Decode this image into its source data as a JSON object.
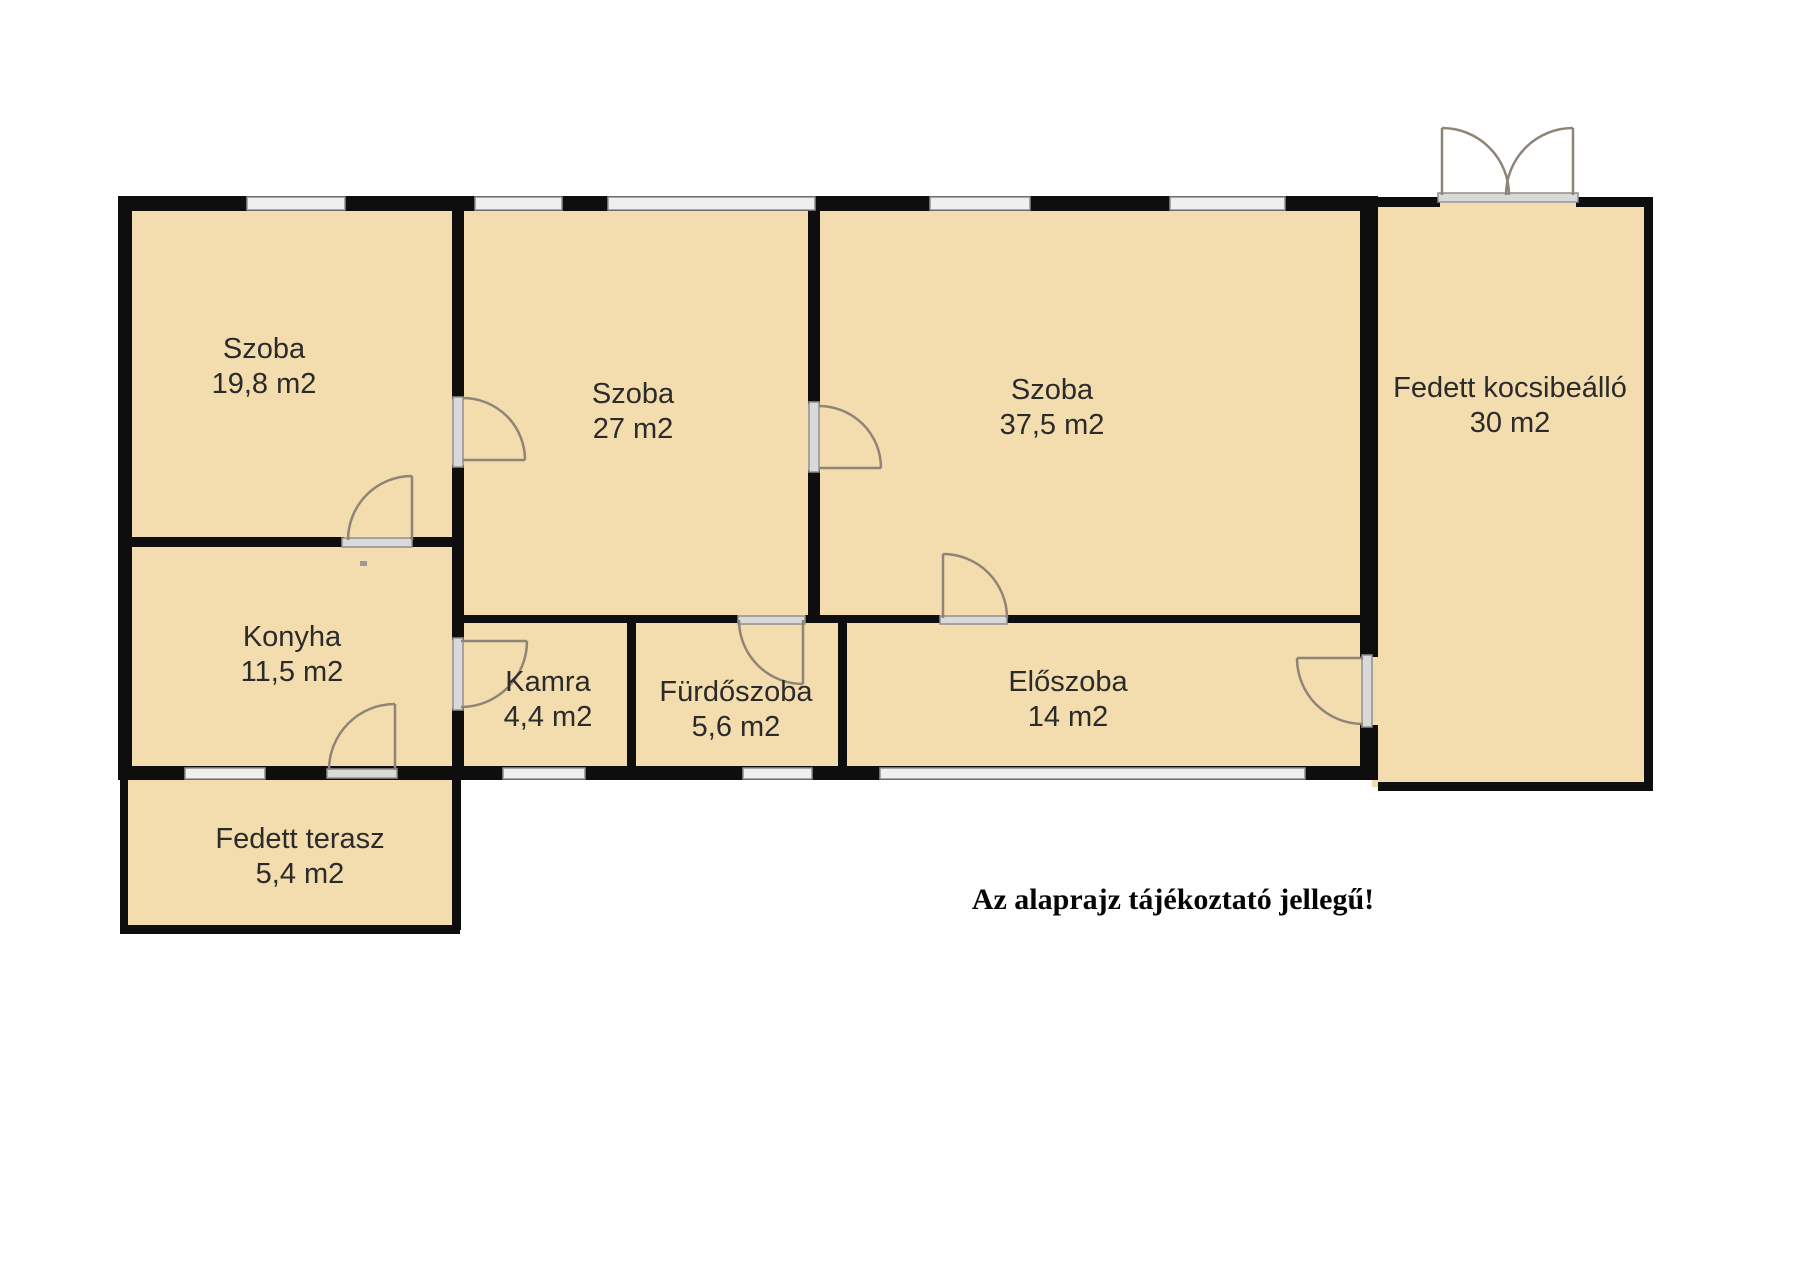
{
  "plan": {
    "disclaimer": "Az alaprajz tájékoztató jellegű!",
    "disclaimer_pos": {
      "x": 1173,
      "y": 900
    },
    "colors": {
      "floor": "#f3dcae",
      "wall": "#0e0e0e",
      "window_fill": "#efefef",
      "window_edge": "#8f8f8f",
      "door_bar_fill": "#d9d9d9",
      "door_bar_edge": "#8f8f8f",
      "door_arc": "#8e8577",
      "label_text": "#2b2b2b",
      "background": "#ffffff"
    },
    "rooms": [
      {
        "key": "szoba-19-8",
        "name": "Szoba",
        "area": "19,8 m2",
        "x": 264,
        "y": 367
      },
      {
        "key": "szoba-27",
        "name": "Szoba",
        "area": "27 m2",
        "x": 633,
        "y": 412
      },
      {
        "key": "szoba-37-5",
        "name": "Szoba",
        "area": "37,5 m2",
        "x": 1052,
        "y": 408
      },
      {
        "key": "fedett-kocsibeallo",
        "name": "Fedett kocsibeálló",
        "area": "30 m2",
        "x": 1510,
        "y": 406
      },
      {
        "key": "konyha",
        "name": "Konyha",
        "area": "11,5 m2",
        "x": 292,
        "y": 655
      },
      {
        "key": "kamra",
        "name": "Kamra",
        "area": "4,4 m2",
        "x": 548,
        "y": 700
      },
      {
        "key": "furdoszoba",
        "name": "Fürdőszoba",
        "area": "5,6 m2",
        "x": 736,
        "y": 710
      },
      {
        "key": "eloszoba",
        "name": "Előszoba",
        "area": "14 m2",
        "x": 1068,
        "y": 700
      },
      {
        "key": "fedett-terasz",
        "name": "Fedett terasz",
        "area": "5,4 m2",
        "x": 300,
        "y": 857
      }
    ],
    "floors": [
      {
        "n": "main-building-floor",
        "x": 125,
        "y": 203,
        "w": 1242,
        "h": 570
      },
      {
        "n": "carport-floor",
        "x": 1372,
        "y": 203,
        "w": 278,
        "h": 584
      },
      {
        "n": "terrace-floor",
        "x": 123,
        "y": 775,
        "w": 334,
        "h": 155
      }
    ],
    "walls": [
      {
        "n": "exterior-top-wall",
        "x": 118,
        "y": 196,
        "w": 1260,
        "h": 15
      },
      {
        "n": "exterior-left-wall",
        "x": 118,
        "y": 196,
        "w": 14,
        "h": 584
      },
      {
        "n": "exterior-bottom-wall",
        "x": 118,
        "y": 766,
        "w": 1260,
        "h": 14
      },
      {
        "n": "exterior-right-wall-upper",
        "x": 1360,
        "y": 196,
        "w": 18,
        "h": 461
      },
      {
        "n": "exterior-right-wall-lower",
        "x": 1360,
        "y": 725,
        "w": 18,
        "h": 55
      },
      {
        "n": "wall-szoba198-szoba27-upper",
        "x": 452,
        "y": 207,
        "w": 12,
        "h": 192
      },
      {
        "n": "wall-konyha-kamra-upper",
        "x": 452,
        "y": 465,
        "w": 12,
        "h": 175
      },
      {
        "n": "wall-konyha-kamra-lower",
        "x": 452,
        "y": 708,
        "w": 12,
        "h": 60
      },
      {
        "n": "wall-szoba198-konyha-left",
        "x": 125,
        "y": 537,
        "w": 219,
        "h": 10
      },
      {
        "n": "wall-szoba198-konyha-right",
        "x": 410,
        "y": 537,
        "w": 42,
        "h": 10
      },
      {
        "n": "wall-szoba27-szoba375-upper",
        "x": 808,
        "y": 207,
        "w": 12,
        "h": 197
      },
      {
        "n": "wall-szoba27-szoba375-lower",
        "x": 808,
        "y": 470,
        "w": 12,
        "h": 147
      },
      {
        "n": "wall-middle-horizontal-1",
        "x": 457,
        "y": 615,
        "w": 281,
        "h": 8
      },
      {
        "n": "wall-middle-horizontal-2",
        "x": 805,
        "y": 615,
        "w": 135,
        "h": 8
      },
      {
        "n": "wall-middle-horizontal-3",
        "x": 1007,
        "y": 615,
        "w": 353,
        "h": 8
      },
      {
        "n": "wall-kamra-furdoszoba",
        "x": 627,
        "y": 621,
        "w": 9,
        "h": 147
      },
      {
        "n": "wall-furdoszoba-eloszoba",
        "x": 838,
        "y": 621,
        "w": 9,
        "h": 147
      },
      {
        "n": "terrace-left-wall",
        "x": 120,
        "y": 780,
        "w": 8,
        "h": 150
      },
      {
        "n": "terrace-bottom-wall",
        "x": 120,
        "y": 925,
        "w": 340,
        "h": 9
      },
      {
        "n": "terrace-right-wall",
        "x": 452,
        "y": 780,
        "w": 9,
        "h": 150
      },
      {
        "n": "carport-top-wall-left",
        "x": 1378,
        "y": 197,
        "w": 62,
        "h": 10
      },
      {
        "n": "carport-top-wall-right",
        "x": 1576,
        "y": 197,
        "w": 77,
        "h": 10
      },
      {
        "n": "carport-right-wall",
        "x": 1644,
        "y": 197,
        "w": 9,
        "h": 594
      },
      {
        "n": "carport-bottom-wall",
        "x": 1378,
        "y": 782,
        "w": 275,
        "h": 9
      }
    ],
    "windows": [
      {
        "n": "window-szoba198-top",
        "x": 247,
        "y": 197,
        "w": 98,
        "h": 13
      },
      {
        "n": "window-szoba27-top-1",
        "x": 475,
        "y": 197,
        "w": 87,
        "h": 13
      },
      {
        "n": "window-szoba27-top-2",
        "x": 608,
        "y": 197,
        "w": 207,
        "h": 13
      },
      {
        "n": "window-szoba375-top-1",
        "x": 930,
        "y": 197,
        "w": 100,
        "h": 13
      },
      {
        "n": "window-szoba375-top-2",
        "x": 1170,
        "y": 197,
        "w": 115,
        "h": 13
      },
      {
        "n": "window-konyha-bottom",
        "x": 185,
        "y": 768,
        "w": 80,
        "h": 11
      },
      {
        "n": "window-kamra-bottom",
        "x": 503,
        "y": 768,
        "w": 82,
        "h": 11
      },
      {
        "n": "window-furdoszoba-bottom",
        "x": 743,
        "y": 768,
        "w": 69,
        "h": 11
      },
      {
        "n": "window-eloszoba-bottom",
        "x": 880,
        "y": 768,
        "w": 425,
        "h": 11
      }
    ],
    "door_bars": [
      {
        "n": "door-frame-szoba198-szoba27",
        "x": 453,
        "y": 397,
        "w": 10,
        "h": 70
      },
      {
        "n": "door-frame-szoba27-szoba375",
        "x": 809,
        "y": 402,
        "w": 10,
        "h": 70
      },
      {
        "n": "door-frame-szoba198-konyha",
        "x": 342,
        "y": 538,
        "w": 70,
        "h": 9
      },
      {
        "n": "door-frame-konyha-terasz",
        "x": 327,
        "y": 769,
        "w": 70,
        "h": 9
      },
      {
        "n": "door-frame-konyha-kamra",
        "x": 453,
        "y": 638,
        "w": 10,
        "h": 72
      },
      {
        "n": "door-frame-szoba27-furdoszoba",
        "x": 738,
        "y": 616,
        "w": 67,
        "h": 8
      },
      {
        "n": "door-frame-szoba375-eloszoba",
        "x": 940,
        "y": 616,
        "w": 67,
        "h": 8
      },
      {
        "n": "door-frame-eloszoba-kocsibeallo",
        "x": 1362,
        "y": 655,
        "w": 10,
        "h": 72
      },
      {
        "n": "door-threshold-kocsibeallo",
        "x": 1438,
        "y": 193,
        "w": 140,
        "h": 9
      }
    ],
    "doors": [
      {
        "n": "door-swing-szoba198-szoba27",
        "d": "M 463 460 L 525 460 M 525 460 A 62 62 0 0 0 463 398"
      },
      {
        "n": "door-swing-szoba27-szoba375",
        "d": "M 819 468 L 881 468 M 881 468 A 62 62 0 0 0 819 406"
      },
      {
        "n": "door-swing-szoba198-konyha",
        "d": "M 412 540 L 412 476 M 412 476 A 64 64 0 0 0 348 540"
      },
      {
        "n": "door-swing-konyha-terasz",
        "d": "M 395 770 L 395 704 M 395 704 A 66 66 0 0 0 329 770"
      },
      {
        "n": "door-swing-konyha-kamra",
        "d": "M 461 641 L 527 641 M 527 641 A 66 66 0 0 1 461 707"
      },
      {
        "n": "door-swing-szoba27-furdoszoba",
        "d": "M 803 620 L 803 684 M 803 684 A 64 64 0 0 1 739 620"
      },
      {
        "n": "door-swing-szoba375-eloszoba",
        "d": "M 943 618 L 943 554 M 943 554 A 64 64 0 0 1 1007 618"
      },
      {
        "n": "door-swing-eloszoba-kocsibeallo",
        "d": "M 1363 658 L 1297 658 M 1297 658 A 66 66 0 0 0 1363 724"
      },
      {
        "n": "door-swing-carport-left-leaf",
        "d": "M 1442 195 L 1442 128 M 1442 128 A 67 67 0 0 1 1509 195"
      },
      {
        "n": "door-swing-carport-right-leaf",
        "d": "M 1573 195 L 1573 128 M 1573 128 A 67 67 0 0 0 1506 195"
      }
    ],
    "marks": [
      {
        "n": "smudge-artifact",
        "x": 360,
        "y": 561,
        "w": 7,
        "h": 5,
        "c": "#9b9b9b"
      }
    ]
  }
}
